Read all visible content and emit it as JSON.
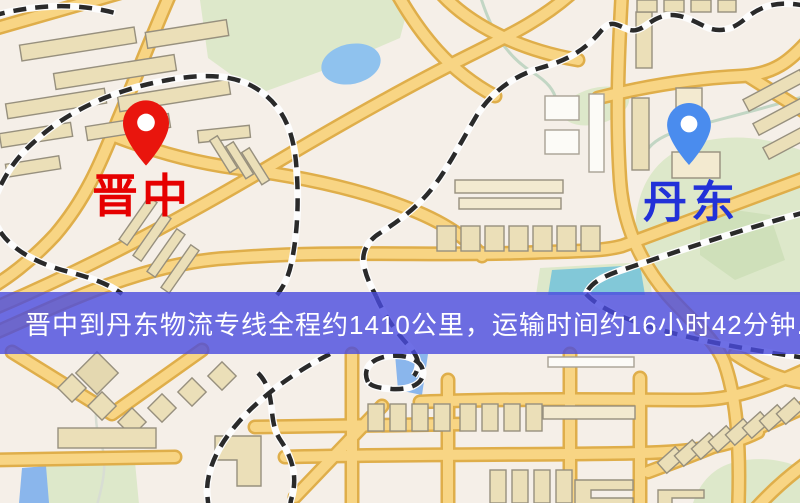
{
  "map": {
    "origin": {
      "label": "晋中",
      "icon": "map-pin",
      "pin_color": "#e9150d",
      "label_color": "#e60000"
    },
    "destination": {
      "label": "丹东",
      "icon": "map-pin",
      "pin_color": "#4a8cee",
      "label_color": "#2231d8"
    },
    "banner": {
      "text": "晋中到丹东物流专线全程约1410公里，运输时间约16小时42分钟.",
      "background": "#4a4bdf",
      "text_color": "#ffffff"
    },
    "route": {
      "origin_city": "晋中",
      "destination_city": "丹东",
      "distance_km": 1410,
      "duration_text": "16小时42分钟"
    },
    "palette": {
      "map_background": "#f5efe8",
      "road_fill": "#f8d584",
      "road_casing": "#dfae4a",
      "building_fill": "#ebdfb8",
      "building_stroke": "#97907e",
      "park_green": "#dde8ca",
      "water_blue": "#8fc2ee",
      "railway_black": "#2a2a2a"
    }
  }
}
